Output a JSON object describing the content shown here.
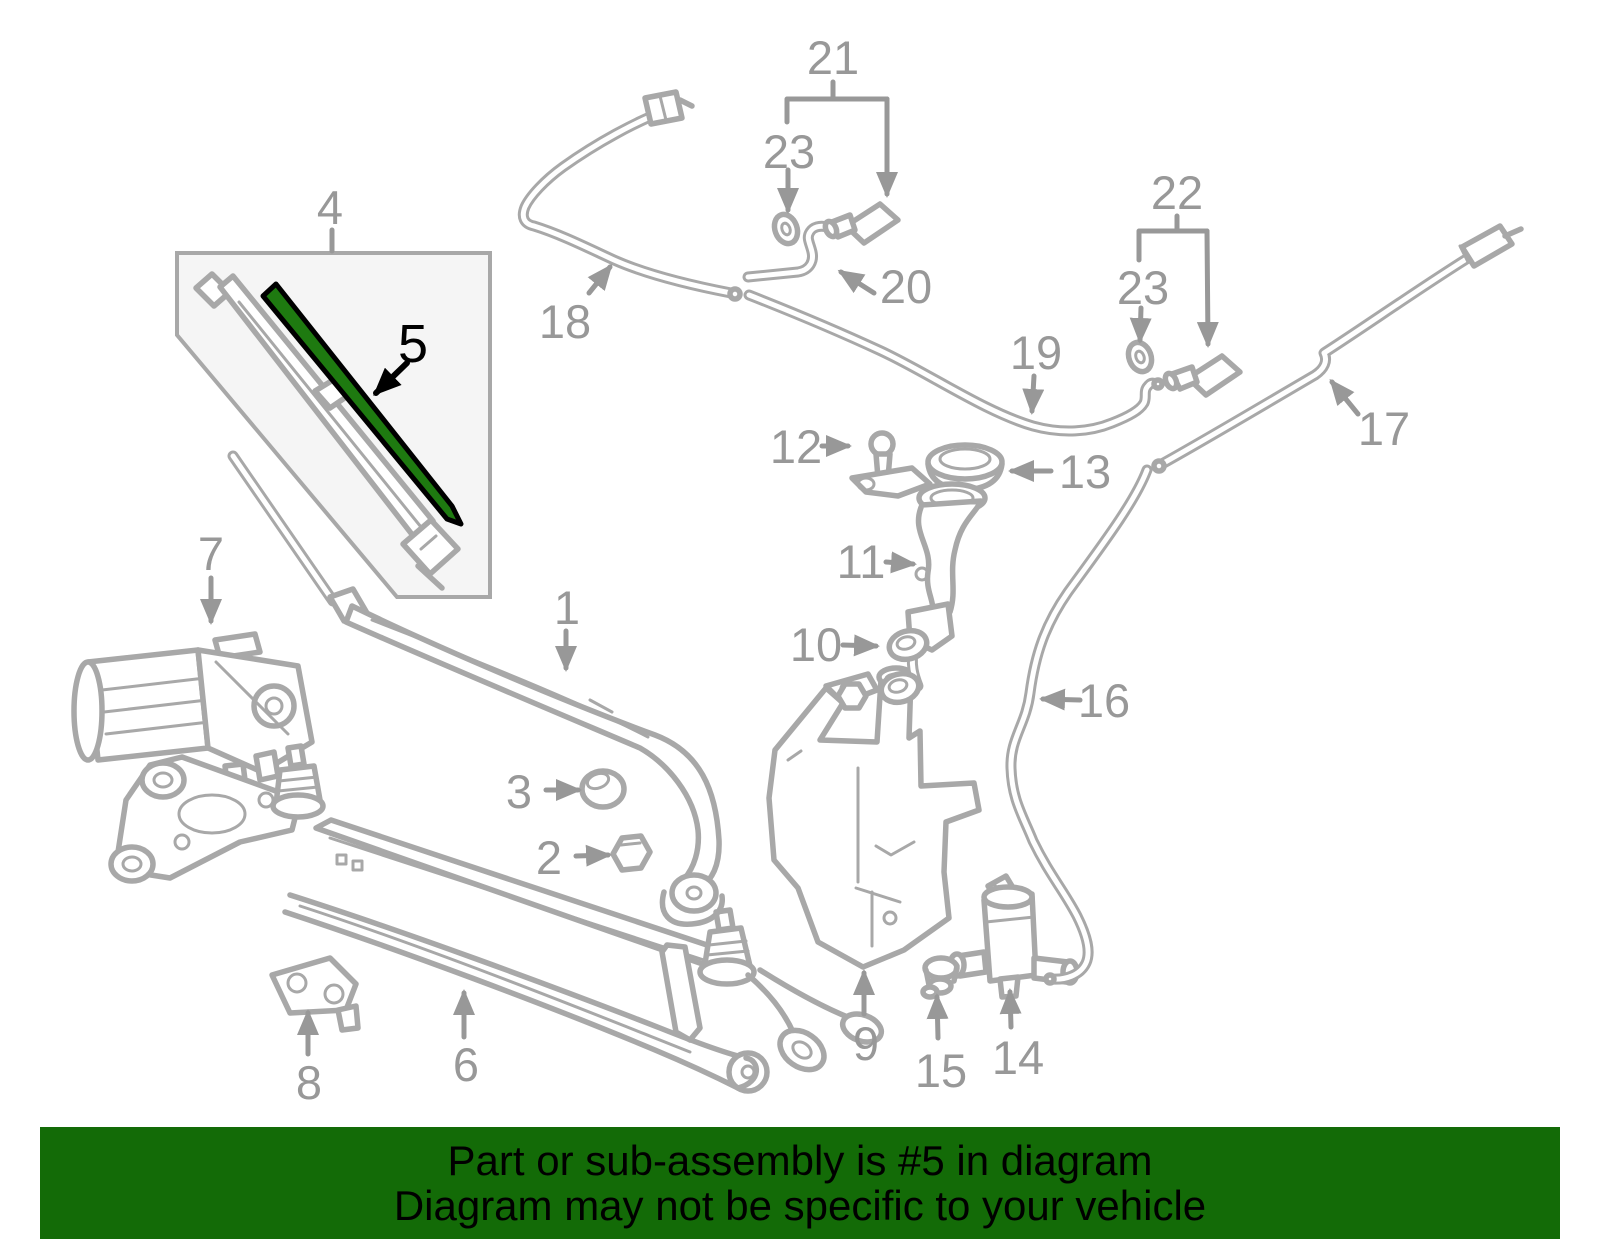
{
  "banner": {
    "line1": "Part or sub-assembly is #5 in diagram",
    "line2": "Diagram may not be specific to your vehicle"
  },
  "colors": {
    "banner-bg": "#136B07",
    "banner-text": "#000000",
    "line": "#a8a8a8",
    "label": "#989898",
    "highlight": "#1e7a10",
    "highlight-outline": "#000000",
    "box-fill": "#f5f5f5",
    "page-bg": "#ffffff"
  },
  "diagram": {
    "highlighted_part": "5",
    "callouts": [
      {
        "label": "1"
      },
      {
        "label": "2"
      },
      {
        "label": "3"
      },
      {
        "label": "4"
      },
      {
        "label": "5"
      },
      {
        "label": "6"
      },
      {
        "label": "7"
      },
      {
        "label": "8"
      },
      {
        "label": "9"
      },
      {
        "label": "10"
      },
      {
        "label": "11"
      },
      {
        "label": "12"
      },
      {
        "label": "13"
      },
      {
        "label": "14"
      },
      {
        "label": "15"
      },
      {
        "label": "16"
      },
      {
        "label": "17"
      },
      {
        "label": "18"
      },
      {
        "label": "19"
      },
      {
        "label": "20"
      },
      {
        "label": "21"
      },
      {
        "label": "22"
      },
      {
        "label": "23"
      },
      {
        "label": "23"
      }
    ]
  }
}
